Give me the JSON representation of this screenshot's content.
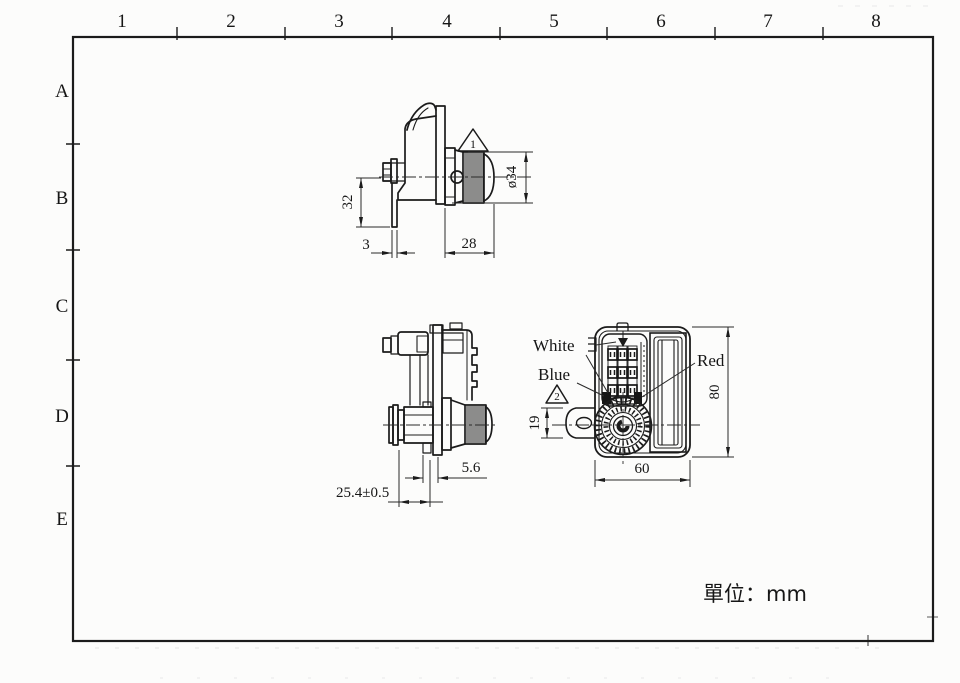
{
  "sheet": {
    "unit_label": "單位：mm",
    "grid_columns": [
      "1",
      "2",
      "3",
      "4",
      "5",
      "6",
      "7",
      "8"
    ],
    "grid_rows": [
      "A",
      "B",
      "C",
      "D",
      "E"
    ]
  },
  "views": {
    "side_upper": {
      "dim_height": "32",
      "dim_tab_thickness": "3",
      "dim_depth": "28",
      "dim_knob_diameter": "ø34",
      "warning_note": "1"
    },
    "side_lower": {
      "dim_flange_offset": "5.6",
      "dim_mount_depth": "25.4±0.5"
    },
    "front": {
      "label_white": "White",
      "label_blue": "Blue",
      "label_red": "Red",
      "dim_ear_height": "19",
      "dim_body_height": "80",
      "dim_body_width": "60",
      "warning_note": "2"
    }
  }
}
